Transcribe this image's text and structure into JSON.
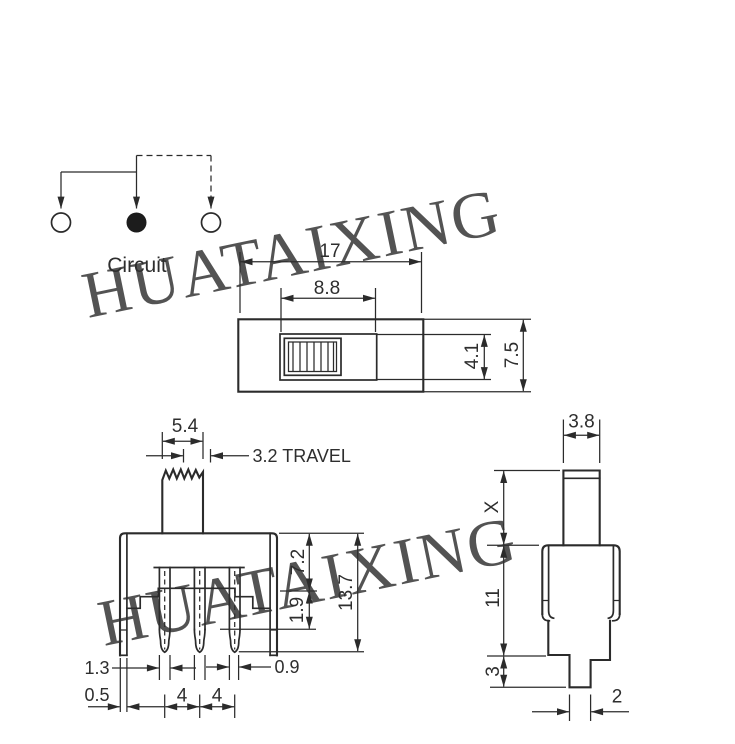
{
  "drawing": {
    "watermark": {
      "text": "HUATAIXING"
    },
    "circuit": {
      "label": "Circuit"
    },
    "top_view": {
      "total_width": "17",
      "slot_width": "8.8",
      "slot_height": "4.1",
      "total_height": "7.5"
    },
    "front_view": {
      "knob_width": "5.4",
      "travel": "3.2 TRAVEL",
      "upper_height": "7.2",
      "shoulder_height": "1.9",
      "total_height": "13.7",
      "pin_width": "1.3",
      "bracket_thickness": "0.5",
      "pin_pitch_left": "4",
      "pin_pitch_right": "4",
      "pin_tip_width": "0.9"
    },
    "side_view": {
      "knob_depth": "3.8",
      "knob_height": "X",
      "body_height": "11",
      "pin_length": "3",
      "pin_width": "2"
    },
    "colors": {
      "line": "#2b2b2b",
      "watermark": "#a9b3ec"
    }
  }
}
